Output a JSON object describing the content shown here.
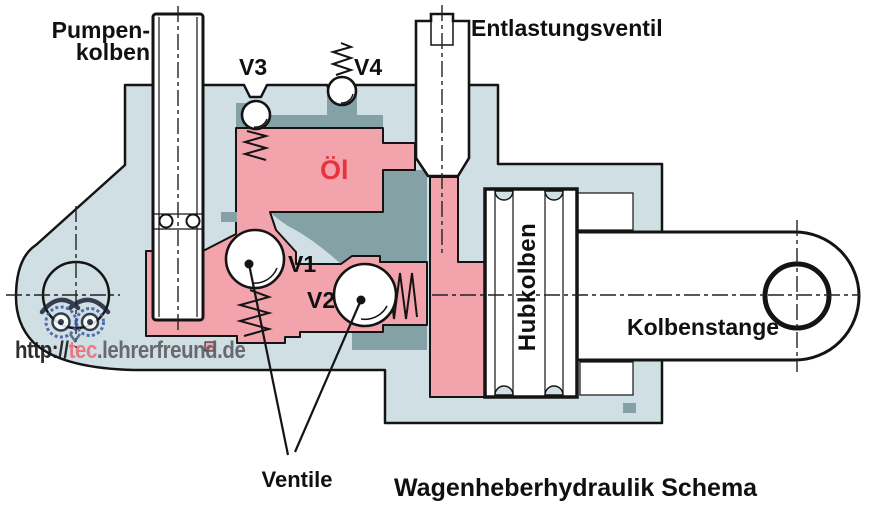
{
  "diagram_title": "Wagenheberhydraulik Schema",
  "labels": {
    "pump_piston_line1": "Pumpen-",
    "pump_piston_line2": "kolben",
    "relief_valve": "Entlastungsventil",
    "valve_v1": "V1",
    "valve_v2": "V2",
    "valve_v3": "V3",
    "valve_v4": "V4",
    "oil": "Öl",
    "lift_piston": "Hubkolben",
    "piston_rod": "Kolbenstange",
    "valves_pointer": "Ventile"
  },
  "watermark": {
    "protocol": "http://",
    "highlight": "tec",
    "rest": ".lehrerfreund.de"
  },
  "colors": {
    "body": "#cfdfe3",
    "pink": "#f2a3ac",
    "slate": "#84a1a6",
    "line": "#141414",
    "oil_text": "#e8323e",
    "wm_red": "#ec6f79",
    "wm_gray": "#5d5d64",
    "wm_black": "#17171c",
    "logo_navy": "#1b2135",
    "logo_blue": "#3a57a8"
  }
}
